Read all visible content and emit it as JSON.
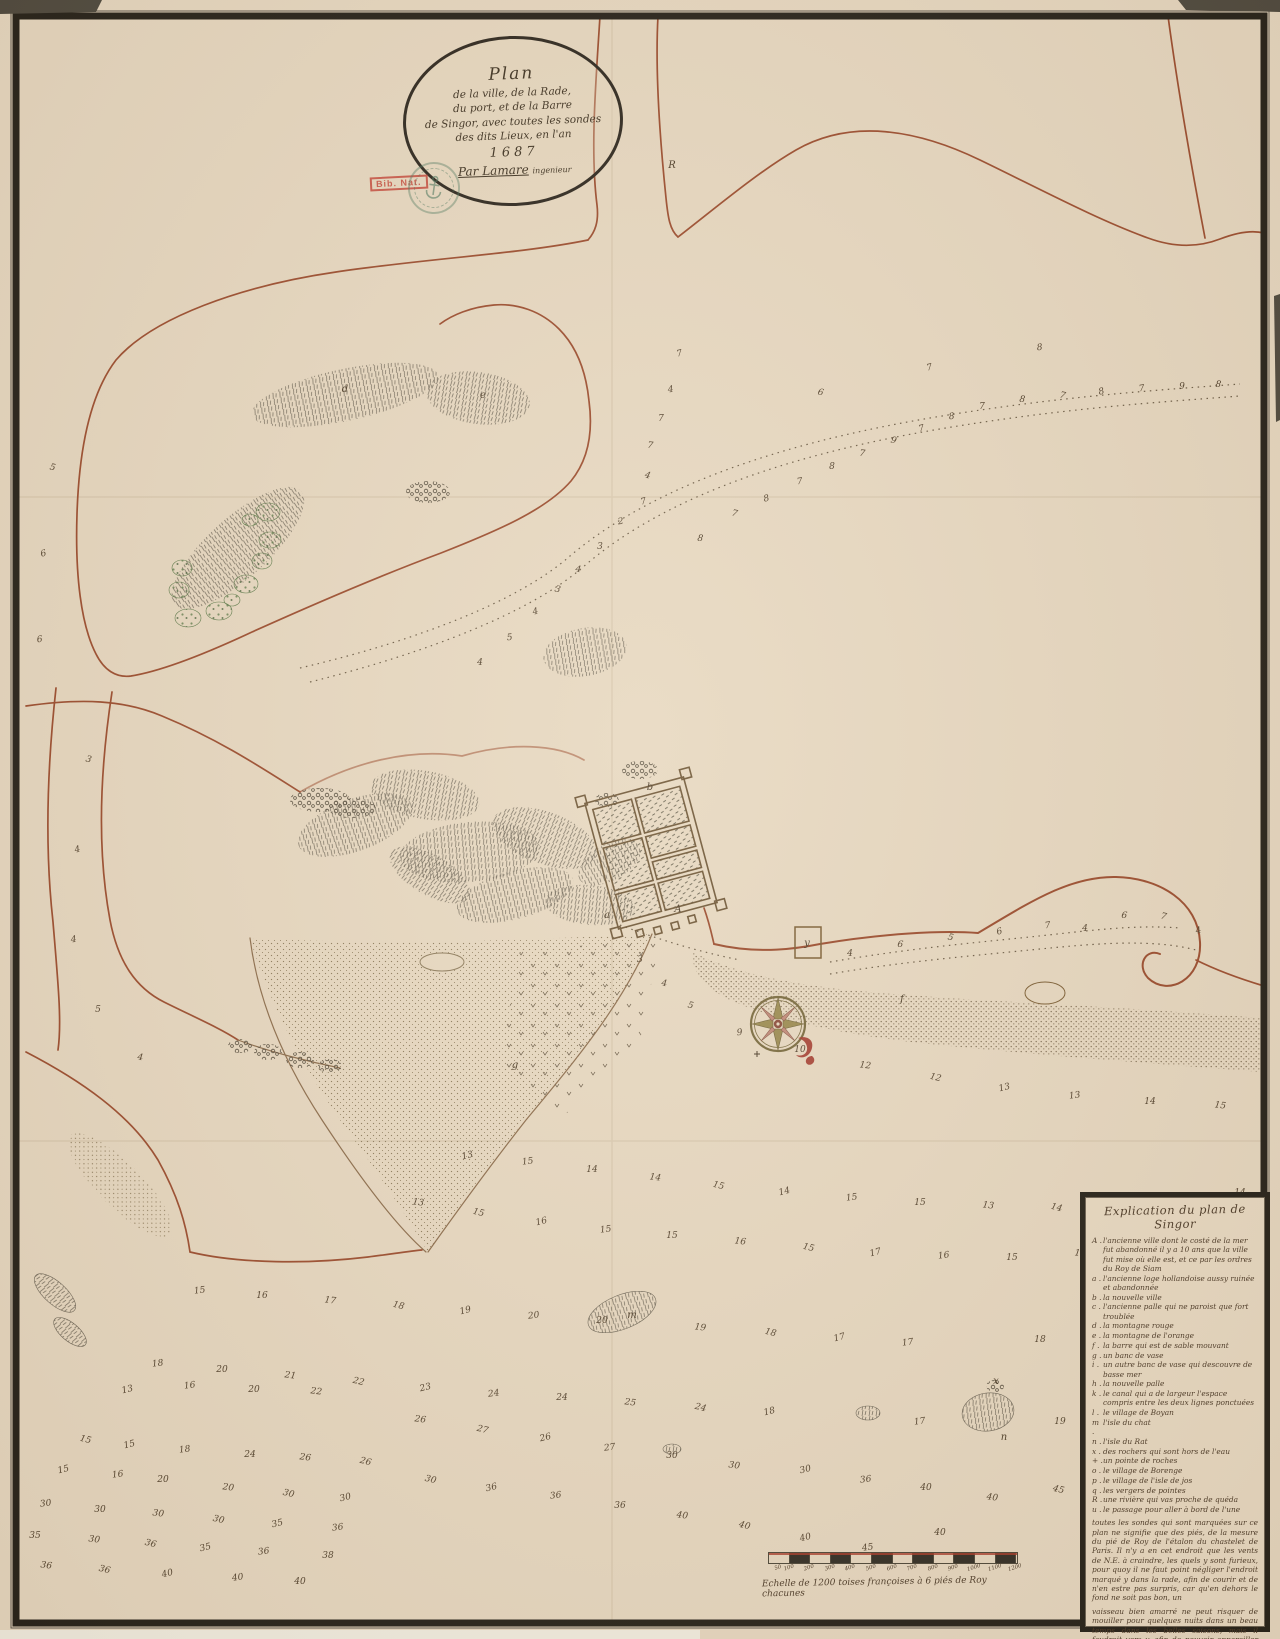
{
  "map": {
    "cartouche": {
      "lines": [
        "Plan",
        "de la ville, de la Rade,",
        "du port, et de la Barre",
        "de Singor, avec toutes les sondes",
        "des dits Lieux, en l'an"
      ],
      "year": "1687",
      "signature": "Par Lamare",
      "signature_title": "ingenieur"
    },
    "stamps": {
      "red_label": "Bib. Nat."
    },
    "legend": {
      "title": "Explication du plan de Singor",
      "entries": [
        {
          "k": "A",
          "t": "l'ancienne ville dont le costé de la mer fut abandonné il y a 10 ans que la ville fut mise où elle est, et ce par les ordres du Roy de Siam"
        },
        {
          "k": "a",
          "t": "l'ancienne loge hollandoise aussy ruinée et abandonnée"
        },
        {
          "k": "b",
          "t": "la nouvelle ville"
        },
        {
          "k": "c",
          "t": "l'ancienne palle qui ne paroist que fort troublée"
        },
        {
          "k": "d",
          "t": "la montagne rouge"
        },
        {
          "k": "e",
          "t": "la montagne de l'orange"
        },
        {
          "k": "f",
          "t": "la barre qui est de sable mouvant"
        },
        {
          "k": "g",
          "t": "un banc de vase"
        },
        {
          "k": "i",
          "t": "un autre banc de vase qui descouvre de basse mer"
        },
        {
          "k": "h",
          "t": "la nouvelle palle"
        },
        {
          "k": "k",
          "t": "le canal qui a de largeur l'espace compris entre les deux lignes ponctuées"
        },
        {
          "k": "l",
          "t": "le village de Boyan"
        },
        {
          "k": "m",
          "t": "l'isle du chat"
        },
        {
          "k": "n",
          "t": "l'isle du Rat"
        },
        {
          "k": "x",
          "t": "des rochers qui sont hors de l'eau"
        },
        {
          "k": "+",
          "t": "un pointe de roches"
        },
        {
          "k": "o",
          "t": "le village de Borenge"
        },
        {
          "k": "p",
          "t": "le village de l'isle de jos"
        },
        {
          "k": "q",
          "t": "les vergers de pointes"
        },
        {
          "k": "R",
          "t": "une rivière qui vas proche de quéda"
        },
        {
          "k": "u",
          "t": "le passage pour aller à bord de l'une"
        }
      ],
      "notes": [
        "toutes les sondes qui sont marquées sur ce plan ne signifie que des piés, de la mesure du pié de Roy de l'étalon du chastelet de Paris. Il n'y a en cet endroit que les vents de N.E. à craindre, les quels y sont furieux, pour quoy il ne faut point négliger l'endroit marqué y dans la rade, afin de courir et de n'en estre pas surpris, car qu'en dehors le fond ne soit pas bon, un",
        "vaisseau bien amarré ne peut risquer de mouiller pour quelques nuits dans un beau temps dans les belles saisons, mais il faudroit vers y, afin de pouvoir appareiller promptement de la rade y, où il y a 19 piés d'eau de basse mer, et les autres sondes sont aussy de basse mer"
      ]
    },
    "scale_bar": {
      "ticks": [
        "50",
        "100",
        "200",
        "300",
        "400",
        "500",
        "600",
        "700",
        "800",
        "900",
        "1000",
        "1100",
        "1200"
      ],
      "caption": "Echelle de 1200 toises françoises à 6 piés de Roy chacunes"
    },
    "letters": [
      [
        672,
        168,
        "R"
      ],
      [
        345,
        392,
        "d"
      ],
      [
        483,
        398,
        "e"
      ],
      [
        650,
        790,
        "b"
      ],
      [
        607,
        918,
        "a"
      ],
      [
        678,
        912,
        "A"
      ],
      [
        807,
        946,
        "y"
      ],
      [
        902,
        1002,
        "f"
      ],
      [
        515,
        1068,
        "g"
      ],
      [
        632,
        1318,
        "m"
      ],
      [
        1004,
        1440,
        "n"
      ],
      [
        996,
        1384,
        "x"
      ]
    ],
    "soundings": [
      [
        680,
        356,
        "7"
      ],
      [
        671,
        392,
        "4"
      ],
      [
        661,
        421,
        "7"
      ],
      [
        650,
        448,
        "7"
      ],
      [
        647,
        478,
        "4"
      ],
      [
        644,
        504,
        "7"
      ],
      [
        621,
        524,
        "2"
      ],
      [
        600,
        549,
        "3"
      ],
      [
        578,
        572,
        "4"
      ],
      [
        557,
        592,
        "3"
      ],
      [
        536,
        614,
        "4"
      ],
      [
        510,
        640,
        "5"
      ],
      [
        480,
        665,
        "4"
      ],
      [
        700,
        541,
        "8"
      ],
      [
        734,
        516,
        "7"
      ],
      [
        767,
        501,
        "8"
      ],
      [
        800,
        484,
        "7"
      ],
      [
        832,
        469,
        "8"
      ],
      [
        862,
        456,
        "7"
      ],
      [
        893,
        443,
        "9"
      ],
      [
        922,
        431,
        "7"
      ],
      [
        952,
        419,
        "8"
      ],
      [
        982,
        409,
        "7"
      ],
      [
        1022,
        402,
        "8"
      ],
      [
        1062,
        398,
        "7"
      ],
      [
        1102,
        394,
        "8"
      ],
      [
        1142,
        391,
        "7"
      ],
      [
        1182,
        389,
        "9"
      ],
      [
        1218,
        387,
        "8"
      ],
      [
        820,
        395,
        "6"
      ],
      [
        930,
        370,
        "7"
      ],
      [
        1040,
        350,
        "8"
      ],
      [
        850,
        956,
        "4"
      ],
      [
        900,
        947,
        "6"
      ],
      [
        950,
        940,
        "5"
      ],
      [
        1000,
        934,
        "6"
      ],
      [
        1048,
        928,
        "7"
      ],
      [
        1085,
        931,
        "4"
      ],
      [
        1124,
        918,
        "6"
      ],
      [
        1163,
        919,
        "7"
      ],
      [
        1199,
        933,
        "4"
      ],
      [
        740,
        1035,
        "9"
      ],
      [
        800,
        1052,
        "10"
      ],
      [
        865,
        1068,
        "12"
      ],
      [
        935,
        1080,
        "12"
      ],
      [
        1005,
        1090,
        "13"
      ],
      [
        1075,
        1098,
        "13"
      ],
      [
        1150,
        1104,
        "14"
      ],
      [
        1220,
        1108,
        "15"
      ],
      [
        88,
        762,
        "3"
      ],
      [
        78,
        852,
        "4"
      ],
      [
        74,
        942,
        "4"
      ],
      [
        98,
        1012,
        "5"
      ],
      [
        140,
        1060,
        "4"
      ],
      [
        52,
        470,
        "5"
      ],
      [
        44,
        556,
        "6"
      ],
      [
        40,
        642,
        "6"
      ],
      [
        640,
        962,
        "3"
      ],
      [
        664,
        986,
        "4"
      ],
      [
        690,
        1008,
        "5"
      ],
      [
        468,
        1158,
        "13"
      ],
      [
        528,
        1164,
        "15"
      ],
      [
        592,
        1172,
        "14"
      ],
      [
        655,
        1180,
        "14"
      ],
      [
        718,
        1188,
        "15"
      ],
      [
        785,
        1194,
        "14"
      ],
      [
        852,
        1200,
        "15"
      ],
      [
        920,
        1205,
        "15"
      ],
      [
        988,
        1208,
        "13"
      ],
      [
        1056,
        1210,
        "14"
      ],
      [
        1124,
        1206,
        "15"
      ],
      [
        1190,
        1200,
        "13"
      ],
      [
        1240,
        1195,
        "14"
      ],
      [
        418,
        1205,
        "13"
      ],
      [
        478,
        1215,
        "15"
      ],
      [
        542,
        1224,
        "16"
      ],
      [
        606,
        1232,
        "15"
      ],
      [
        672,
        1238,
        "15"
      ],
      [
        740,
        1244,
        "16"
      ],
      [
        808,
        1250,
        "15"
      ],
      [
        876,
        1255,
        "17"
      ],
      [
        944,
        1258,
        "16"
      ],
      [
        1012,
        1260,
        "15"
      ],
      [
        1080,
        1256,
        "15"
      ],
      [
        1148,
        1250,
        "15"
      ],
      [
        1212,
        1244,
        "14"
      ],
      [
        200,
        1293,
        "15"
      ],
      [
        262,
        1298,
        "16"
      ],
      [
        330,
        1303,
        "17"
      ],
      [
        398,
        1308,
        "18"
      ],
      [
        466,
        1313,
        "19"
      ],
      [
        534,
        1318,
        "20"
      ],
      [
        602,
        1323,
        "20"
      ],
      [
        700,
        1330,
        "19"
      ],
      [
        770,
        1335,
        "18"
      ],
      [
        840,
        1340,
        "17"
      ],
      [
        908,
        1345,
        "17"
      ],
      [
        1040,
        1342,
        "18"
      ],
      [
        1108,
        1337,
        "18"
      ],
      [
        1176,
        1332,
        "19"
      ],
      [
        1238,
        1327,
        "18"
      ],
      [
        158,
        1366,
        "18"
      ],
      [
        222,
        1372,
        "20"
      ],
      [
        290,
        1378,
        "21"
      ],
      [
        358,
        1384,
        "22"
      ],
      [
        426,
        1390,
        "23"
      ],
      [
        494,
        1396,
        "24"
      ],
      [
        562,
        1400,
        "24"
      ],
      [
        630,
        1405,
        "25"
      ],
      [
        700,
        1410,
        "24"
      ],
      [
        770,
        1414,
        "18"
      ],
      [
        920,
        1424,
        "17"
      ],
      [
        1060,
        1424,
        "19"
      ],
      [
        1130,
        1418,
        "18"
      ],
      [
        1198,
        1412,
        "17"
      ],
      [
        128,
        1392,
        "13"
      ],
      [
        190,
        1388,
        "16"
      ],
      [
        254,
        1392,
        "20"
      ],
      [
        316,
        1394,
        "22"
      ],
      [
        85,
        1442,
        "15"
      ],
      [
        130,
        1447,
        "15"
      ],
      [
        185,
        1452,
        "18"
      ],
      [
        250,
        1457,
        "24"
      ],
      [
        305,
        1460,
        "26"
      ],
      [
        365,
        1464,
        "26"
      ],
      [
        64,
        1472,
        "15"
      ],
      [
        118,
        1477,
        "16"
      ],
      [
        163,
        1482,
        "20"
      ],
      [
        228,
        1490,
        "20"
      ],
      [
        288,
        1496,
        "30"
      ],
      [
        346,
        1500,
        "30"
      ],
      [
        46,
        1506,
        "30"
      ],
      [
        100,
        1512,
        "30"
      ],
      [
        158,
        1516,
        "30"
      ],
      [
        218,
        1522,
        "30"
      ],
      [
        278,
        1526,
        "35"
      ],
      [
        338,
        1530,
        "36"
      ],
      [
        35,
        1538,
        "35"
      ],
      [
        94,
        1542,
        "30"
      ],
      [
        150,
        1546,
        "36"
      ],
      [
        206,
        1550,
        "35"
      ],
      [
        264,
        1554,
        "36"
      ],
      [
        328,
        1558,
        "38"
      ],
      [
        46,
        1568,
        "36"
      ],
      [
        104,
        1572,
        "36"
      ],
      [
        168,
        1576,
        "40"
      ],
      [
        238,
        1580,
        "40"
      ],
      [
        300,
        1584,
        "40"
      ],
      [
        420,
        1422,
        "26"
      ],
      [
        482,
        1432,
        "27"
      ],
      [
        546,
        1440,
        "26"
      ],
      [
        610,
        1450,
        "27"
      ],
      [
        672,
        1458,
        "30"
      ],
      [
        734,
        1468,
        "30"
      ],
      [
        430,
        1482,
        "30"
      ],
      [
        492,
        1490,
        "36"
      ],
      [
        556,
        1498,
        "36"
      ],
      [
        620,
        1508,
        "36"
      ],
      [
        682,
        1518,
        "40"
      ],
      [
        744,
        1528,
        "40"
      ],
      [
        806,
        1472,
        "30"
      ],
      [
        866,
        1482,
        "36"
      ],
      [
        926,
        1490,
        "40"
      ],
      [
        992,
        1500,
        "40"
      ],
      [
        1058,
        1492,
        "45"
      ],
      [
        806,
        1540,
        "40"
      ],
      [
        868,
        1550,
        "45"
      ],
      [
        940,
        1535,
        "40"
      ]
    ]
  }
}
